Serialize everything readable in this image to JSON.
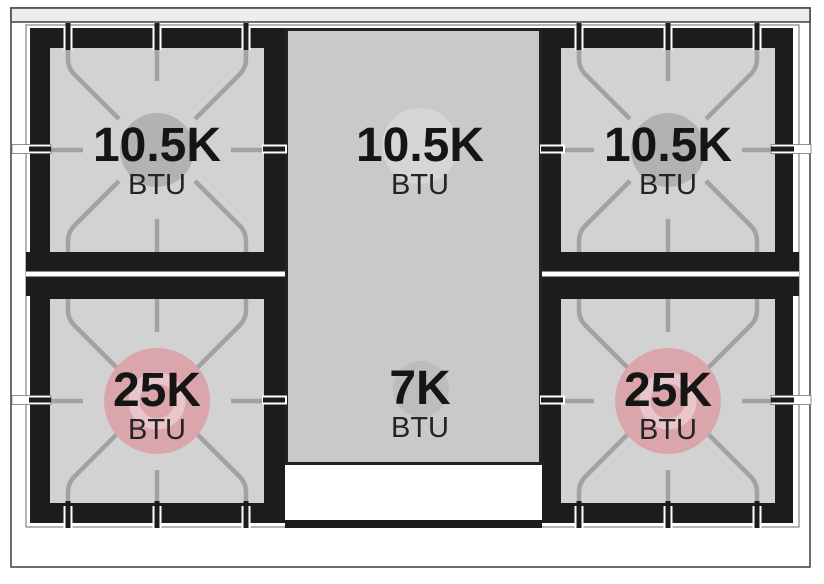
{
  "diagram": {
    "type": "cooktop-burner-layout",
    "burners": [
      {
        "id": "left-rear",
        "position": "top-left",
        "output": "10.5K",
        "unit": "BTU",
        "cap_color": "#b2b2b2"
      },
      {
        "id": "center-rear",
        "position": "top-center",
        "output": "10.5K",
        "unit": "BTU",
        "cap_color": "#d6d6d6"
      },
      {
        "id": "right-rear",
        "position": "top-right",
        "output": "10.5K",
        "unit": "BTU",
        "cap_color": "#b2b2b2"
      },
      {
        "id": "left-front",
        "position": "bottom-left",
        "output": "25K",
        "unit": "BTU",
        "cap_color": "#dba6ab"
      },
      {
        "id": "center-front",
        "position": "bottom-center",
        "output": "7K",
        "unit": "BTU",
        "cap_color": "#bdbdbd"
      },
      {
        "id": "right-front",
        "position": "bottom-right",
        "output": "25K",
        "unit": "BTU",
        "cap_color": "#dba6ab"
      }
    ],
    "colors": {
      "grate_black": "#1c1c1c",
      "burner_square_gray": "#d2d2d2",
      "griddle_gray": "#c9c9c9",
      "grate_line_gray": "#a2a2a2",
      "high_output_pink": "#dba6ab",
      "high_output_ring_pink": "#e9c6c9",
      "text_black": "#151515"
    }
  }
}
